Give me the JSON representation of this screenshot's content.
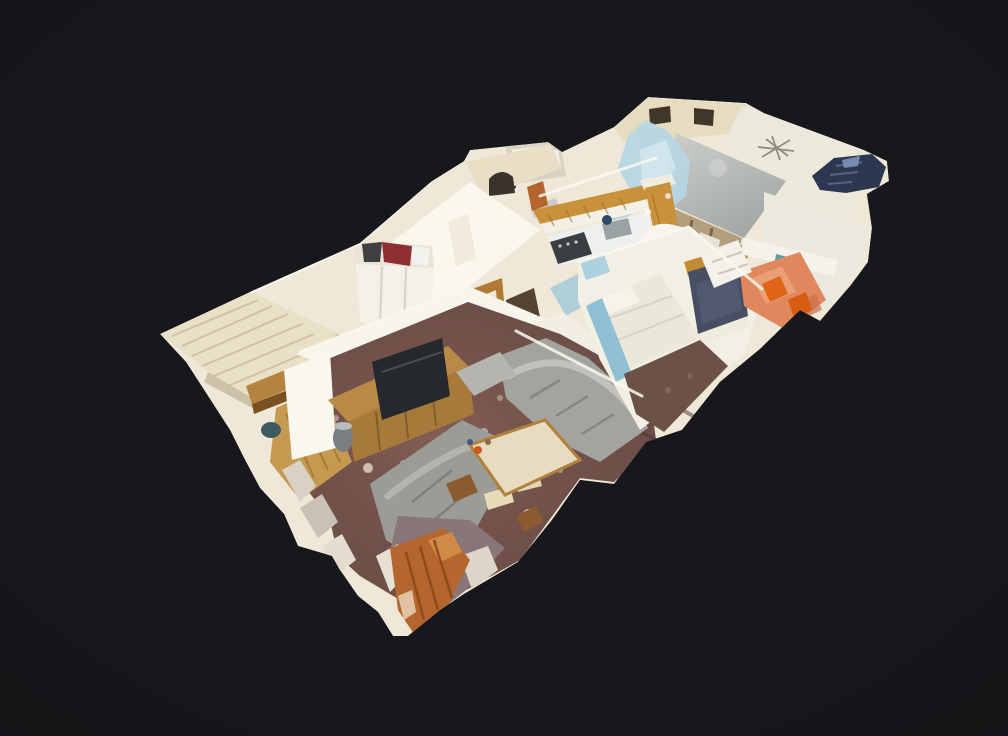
{
  "meta": {
    "app": "3D dollhouse tour viewer",
    "view_mode": "dollhouse",
    "description": "Isometric 3D-scanned dollhouse cutaway of an apartment floating on a dark charcoal background. Rooms visible: kitchen with oak cabinets, bathroom, two bedrooms (one with wardrobe and red garment, one with bed and navy wall panel), sunroom with salmon floor and orange chairs, living room with brown carpet, wood sideboard with TV, two grey sofas and a coffee table, small wood-floor entry nook, exterior cream brick panel, grey ceiling planes with ceiling fan, blue scan artifacts and ragged scan edges."
  },
  "canvas": {
    "width": 1008,
    "height": 736
  },
  "palette": {
    "background": "#17181b",
    "model_base": "#efe8d8",
    "exterior_cream": "#e6dcbf",
    "brick_panel": "#e9e1c6",
    "ceiling_white": "#ece8db",
    "ceiling_gray": "#b9bdb9",
    "scan_blue": "#b7d7e3",
    "stairs_navy": "#2d3850",
    "kitchen_oak": "#c8913c",
    "carpet_brown": "#6f5049",
    "sofa_gray": "#a4a49e",
    "sofa_gray_dark": "#9c9c96",
    "sideboard_wood": "#b98a45",
    "tv_black": "#25282c",
    "salmon_floor": "#e0875e",
    "chair_orange": "#e06418",
    "navy_panel": "#474f63",
    "bed_white": "#ebe7da",
    "bed_trim_blue": "#8fc0d4",
    "wood_floor": "#c59a50",
    "door_wood": "#b4662e",
    "wardrobe_red": "#8e2f33",
    "hall_tan": "#b49f7d",
    "coffee_table_top": "#e7dcc0",
    "pillow_cream": "#e6dcba",
    "bottom_shadow_mauve": "#887679"
  },
  "scene": {
    "elements": [
      "ceiling-fan",
      "arched-doorway",
      "exterior-brick-panel",
      "kitchen-cabinets",
      "kitchen-stove",
      "kitchen-sink",
      "bathtub",
      "wardrobe",
      "bed",
      "navy-wall-panel",
      "salmon-sunroom",
      "orange-chairs",
      "living-room-carpet",
      "tv-sideboard",
      "sofa-upper",
      "sofa-lower",
      "coffee-table",
      "entry-wood-floor",
      "scan-artifact-blue",
      "scan-artifact-stairs",
      "broken-scan-edge-door"
    ]
  }
}
